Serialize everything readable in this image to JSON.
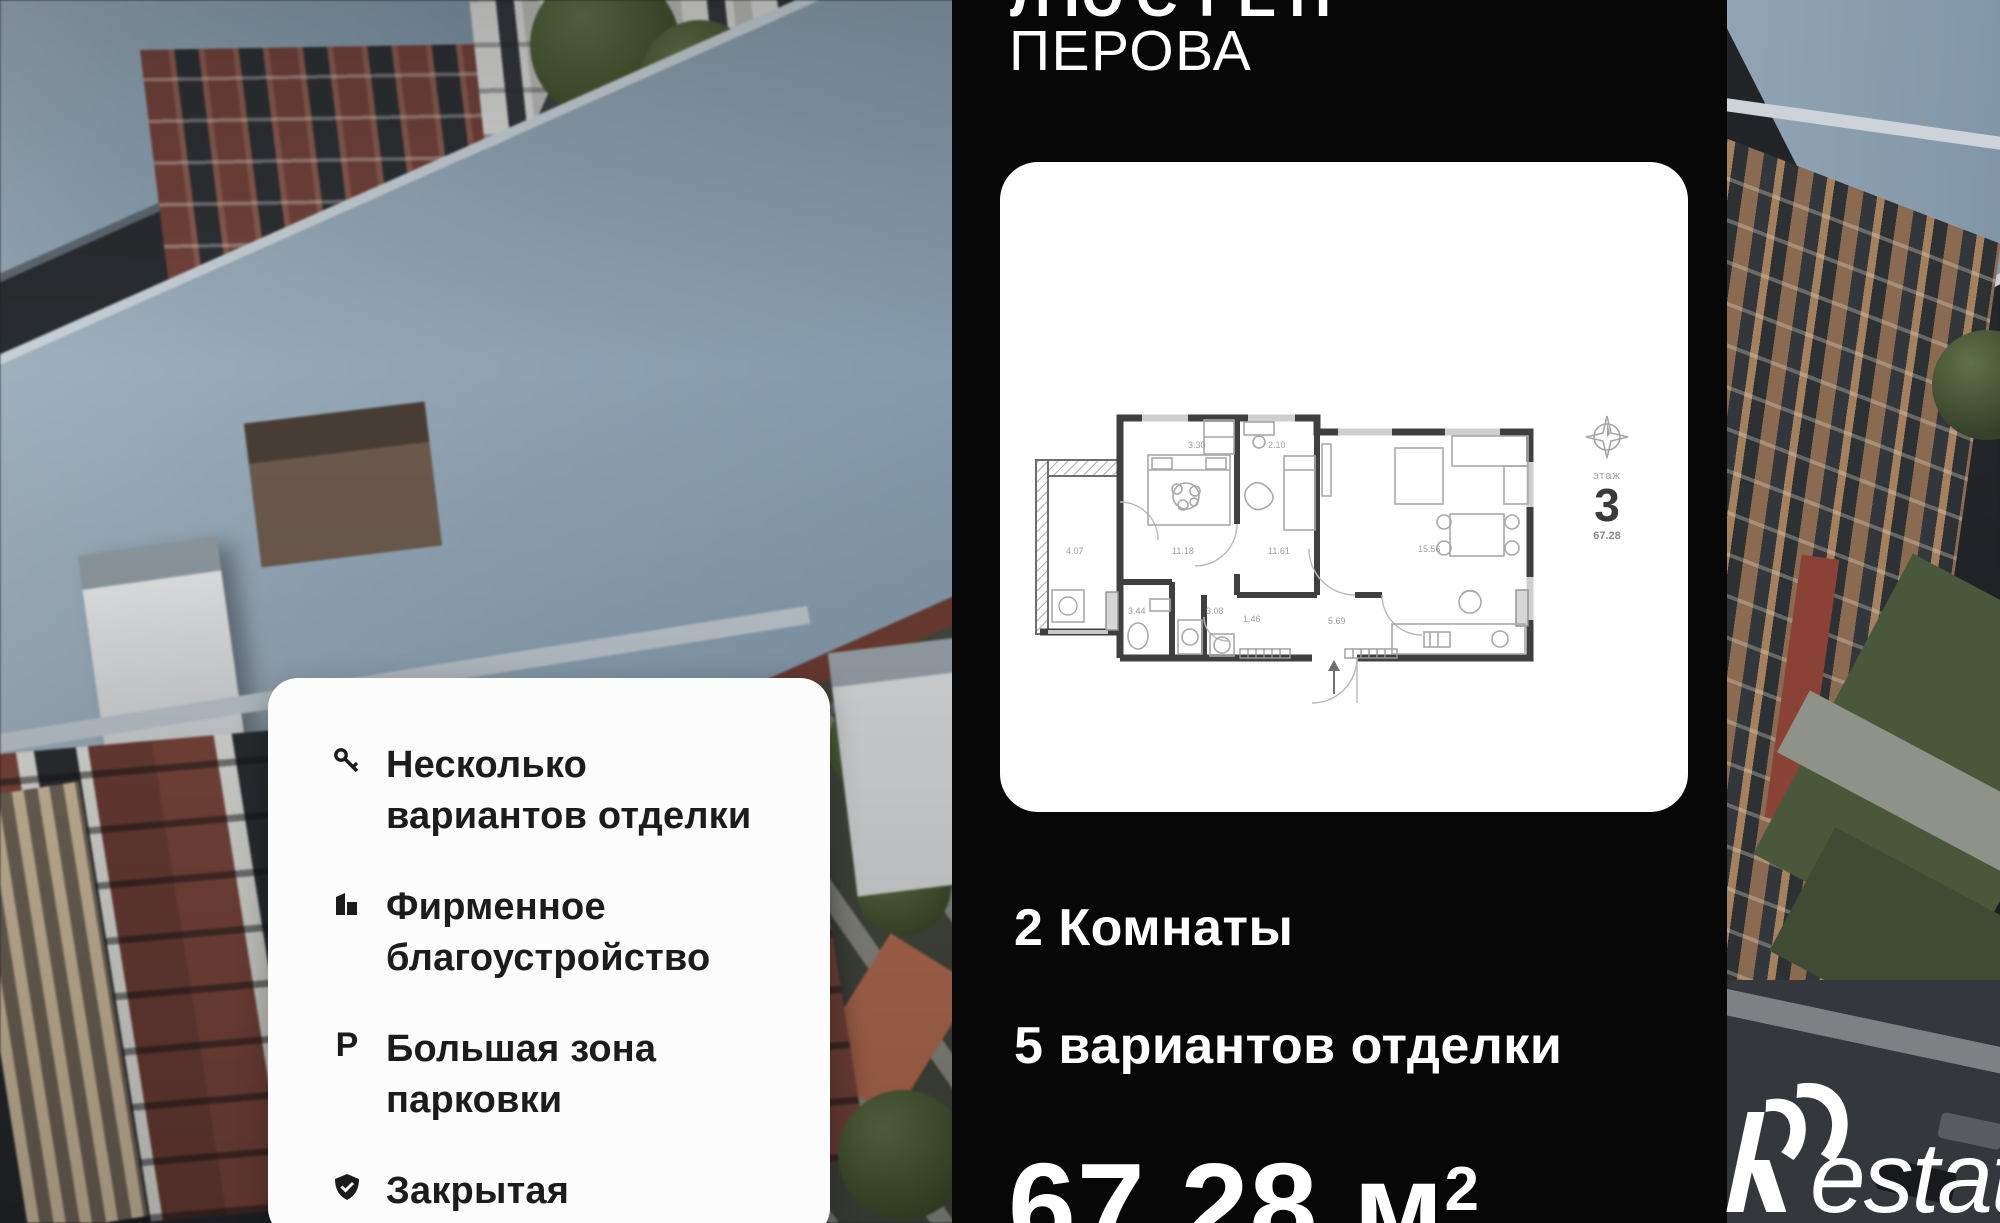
{
  "header": {
    "project_line1_partial": "ЛЮСТЕН",
    "project_line2": "ПЕРОВА"
  },
  "floorplan_card": {
    "floor_label": "этаж",
    "floor_number": "3",
    "floor_area": "67.28",
    "compass_icon": "compass-rose-icon",
    "room_labels": [
      "3.30",
      "2.10",
      "11.18",
      "11.61",
      "15.56",
      "4.07",
      "3.44",
      "3.08",
      "1.46",
      "5.69"
    ]
  },
  "details": {
    "rooms": "2 Комнаты",
    "finishing": "5 вариантов отделки",
    "area": "67.28 м",
    "area_sup": "2"
  },
  "features": {
    "items": [
      {
        "icon": "key-icon",
        "lines": [
          "Несколько",
          "вариантов отделки"
        ]
      },
      {
        "icon": "building-icon",
        "lines": [
          "Фирменное",
          "благоустройство"
        ]
      },
      {
        "icon": "parking-icon",
        "icon_text": "P",
        "lines": [
          "Большая зона",
          "парковки"
        ]
      },
      {
        "icon": "shield-check-icon",
        "lines": [
          "Закрытая",
          "территория"
        ]
      }
    ]
  },
  "watermark": {
    "brand_text": "estate"
  },
  "colors": {
    "panel_black": "#070707",
    "card_white": "#ffffff",
    "roof_blue": "#8da2b3",
    "brick_red": "#74423a",
    "text_dark": "#1c1c1c",
    "wall_grey": "#3f3f3f"
  }
}
